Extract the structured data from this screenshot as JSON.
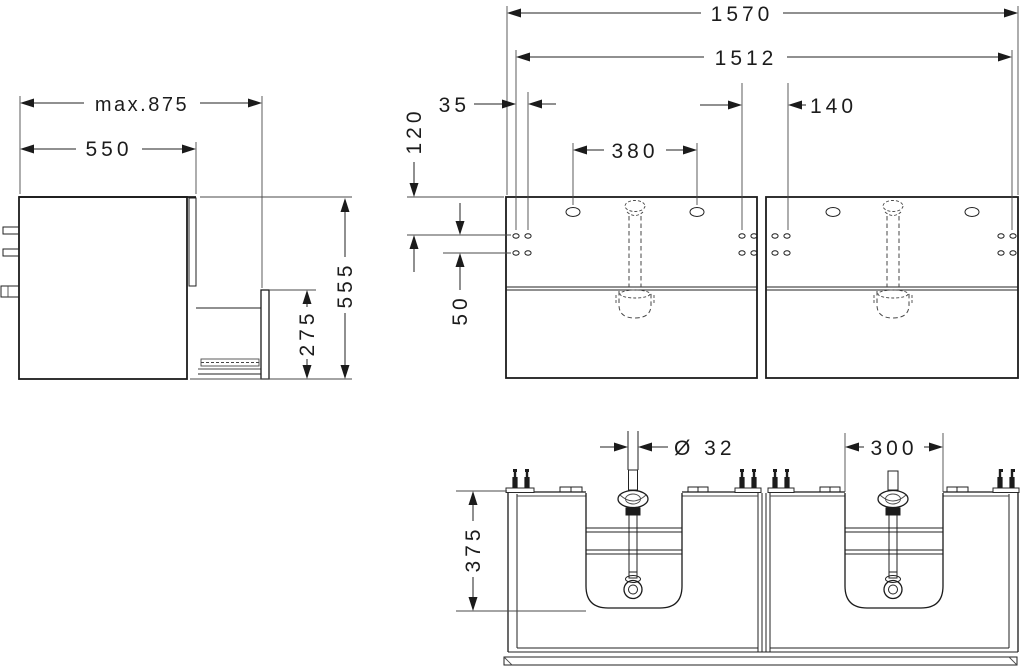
{
  "front_view": {
    "overall_width": "1570",
    "mounting_hole_span": "1512",
    "hole_pair_spacing": "35",
    "center_hole_spacing": "140",
    "faucet_hole_spacing": "380",
    "top_to_first_hole_row": "120",
    "hole_row_gap": "50"
  },
  "side_view": {
    "max_pullout_depth": "max.875",
    "cabinet_depth": "550",
    "cabinet_height": "555",
    "drawer_front_height": "275"
  },
  "bottom_view": {
    "drain_pipe_diameter": "Ø 32",
    "siphon_cutout_width": "300",
    "siphon_cutout_depth": "375"
  }
}
